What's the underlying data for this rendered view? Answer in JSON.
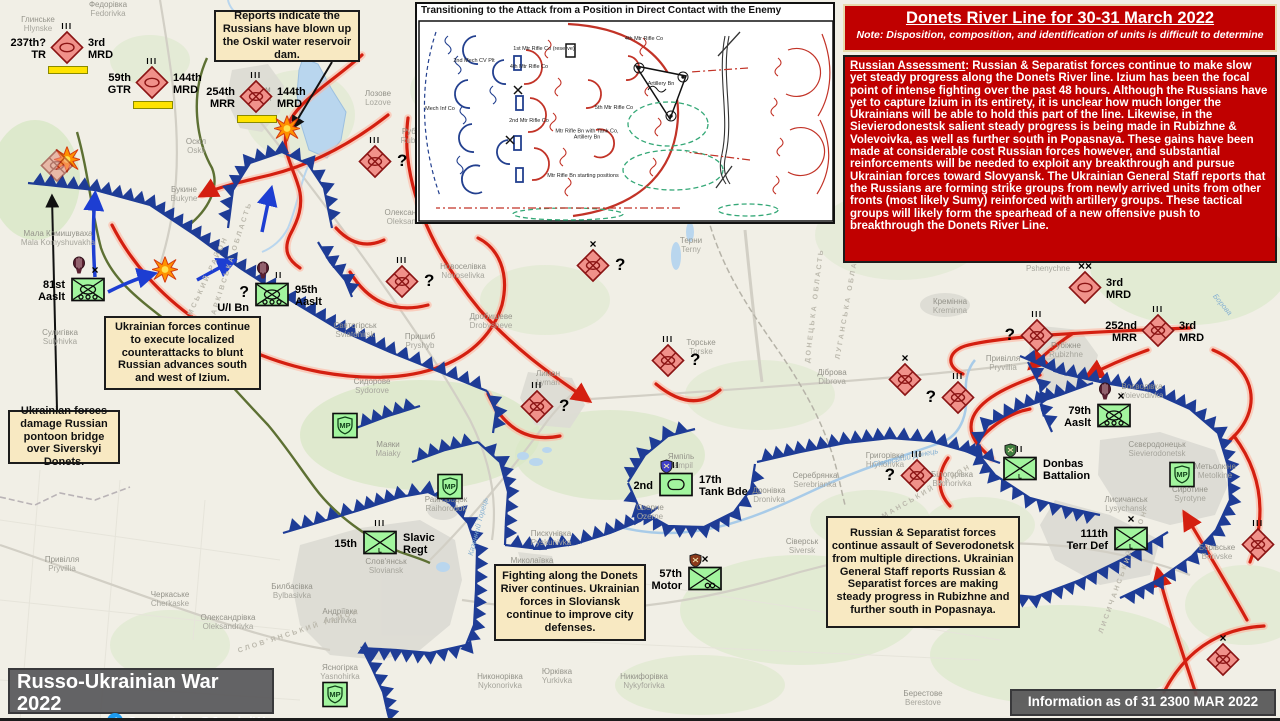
{
  "title_box": {
    "title": "Donets River Line for 30-31 March 2022",
    "note": "Note: Disposition, composition, and identification of units is difficult to determine"
  },
  "assessment": {
    "heading": "Russian Assessment",
    "body": ": Russian & Separatist forces continue to make slow yet steady progress along the Donets River line. Izium has been the focal point of intense fighting over the past 48 hours. Although the Russians have yet to capture Izium in its entirety, it is unclear how much longer the Ukrainians will be able to hold this part of the line. Likewise, in the Sievierodonestsk salient steady progress is being made in Rubizhne & Volevoivka, as well as further south in Popasnaya. These gains have been made at considerable cost Russian forces however, and substantial reinforcements will be needed to exploit any breakthrough and pursue Ukrainian forces toward Slovyansk. The Ukrainian General Staff reports that the Russians are forming strike groups from newly arrived units from other fronts (most likely Sumy) reinforced with artillery groups. These tactical groups will likely form the spearhead of a new offensive push to breakthrough the Donets River Line."
  },
  "inset": {
    "title": "Transitioning to the Attack from a Position in Direct Contact with the Enemy",
    "area_label": "Motorized Rifle Battalion Defensive Area",
    "labels": [
      {
        "text": "1st Mtr Rifle Co (reserve)",
        "x": 127,
        "y": 45
      },
      {
        "text": "4th Mtr Rifle Co",
        "x": 112,
        "y": 63
      },
      {
        "text": "4th Mtr Rifle Co",
        "x": 227,
        "y": 35
      },
      {
        "text": "2nd Mech CV Plt",
        "x": 57,
        "y": 57
      },
      {
        "text": "Mech Inf Co",
        "x": 23,
        "y": 105
      },
      {
        "text": "2nd Mtr Rifle Co",
        "x": 112,
        "y": 117
      },
      {
        "text": "5th Mtr Rifle Co",
        "x": 197,
        "y": 104
      },
      {
        "text": "Mtr Rifle Bn with Tank Co, Artillery Bn",
        "x": 170,
        "y": 131
      },
      {
        "text": "Mtr Rifle Bn starting positions",
        "x": 166,
        "y": 172
      },
      {
        "text": "Artillery Bn",
        "x": 244,
        "y": 80
      }
    ]
  },
  "callouts": [
    {
      "x": 214,
      "y": 10,
      "w": 146,
      "h": 52,
      "text": "Reports indicate the Russians have blown up the Oskil water reservoir dam."
    },
    {
      "x": 104,
      "y": 316,
      "w": 157,
      "h": 74,
      "text": "Ukrainian forces continue to execute localized counterattacks to blunt Russian advances south and west of Izium."
    },
    {
      "x": 8,
      "y": 410,
      "w": 112,
      "h": 54,
      "text": "Ukrainian forces damage Russian pontoon bridge over Siverskyi Donets."
    },
    {
      "x": 494,
      "y": 564,
      "w": 152,
      "h": 77,
      "text": "Fighting along the Donets River continues. Ukrainian forces in Sloviansk continue to improve city defenses."
    },
    {
      "x": 826,
      "y": 516,
      "w": 194,
      "h": 112,
      "text": "Russian & Separatist forces continue assault of Severodonetsk from multiple directions. Ukrainian General Staff reports Russian & Separatist forces are making steady progress in Rubizhne and further south in Popasnaya."
    }
  ],
  "banner": {
    "title": "Russo-Ukrainian War 2022",
    "credit": "Created by @JominiW",
    "icon": "twitter-bird-icon"
  },
  "info_box": {
    "text": "Information as of 31 2300 MAR 2022 (GMT)"
  },
  "colors": {
    "title_red": "#c00000",
    "callout_tan": "#f8e9c2",
    "banner_gray": "#58585a",
    "russian_fill": "#f0918a",
    "russian_border": "#8b1414",
    "ukrainian_fill": "#a2f59e",
    "ukrainian_border": "#0c0c0c",
    "defense_blue": "#1e3c96",
    "attack_red": "#d41f10",
    "attack_glow": "#ffb09a",
    "counter_blue": "#1d3ed2",
    "route_green": "#5d7033",
    "bar_yellow": "#ffe300",
    "water": "#b9d6ee"
  },
  "map": {
    "units": {
      "russian": [
        {
          "x": 67,
          "y": 50,
          "sym": "armor",
          "ech": "III",
          "left": [
            "237th?",
            "TR"
          ],
          "right": [
            "3rd",
            "MRD"
          ],
          "bar": true
        },
        {
          "x": 152,
          "y": 85,
          "sym": "armor",
          "ech": "III",
          "left": [
            "59th",
            "GTR"
          ],
          "right": [
            "144th",
            "MRD"
          ],
          "bar": true
        },
        {
          "x": 256,
          "y": 99,
          "sym": "mech",
          "ech": "III",
          "left": [
            "254th",
            "MRR"
          ],
          "right": [
            "144th",
            "MRD"
          ],
          "bar": true
        },
        {
          "x": 375,
          "y": 164,
          "sym": "mech",
          "ech": "III",
          "q": "right"
        },
        {
          "x": 57,
          "y": 168,
          "sym": "mech",
          "faded": true
        },
        {
          "x": 402,
          "y": 284,
          "sym": "mech",
          "ech": "III",
          "q": "right"
        },
        {
          "x": 593,
          "y": 268,
          "sym": "mech",
          "ech": "x",
          "q": "right"
        },
        {
          "x": 537,
          "y": 409,
          "sym": "mech",
          "ech": "III",
          "q": "right"
        },
        {
          "x": 668,
          "y": 363,
          "sym": "mech",
          "ech": "III",
          "q": "right"
        },
        {
          "x": 1085,
          "y": 290,
          "sym": "armor",
          "ech": "xx",
          "right": [
            "3rd",
            "MRD"
          ]
        },
        {
          "x": 1158,
          "y": 333,
          "sym": "mech",
          "ech": "III",
          "left": [
            "252nd",
            "MRR"
          ],
          "right": [
            "3rd",
            "MRD"
          ]
        },
        {
          "x": 1037,
          "y": 338,
          "sym": "mech",
          "ech": "III",
          "q": "left"
        },
        {
          "x": 958,
          "y": 400,
          "sym": "mech",
          "ech": "III",
          "q": "left"
        },
        {
          "x": 905,
          "y": 382,
          "sym": "mech",
          "ech": "x"
        },
        {
          "x": 917,
          "y": 478,
          "sym": "mech",
          "ech": "III",
          "q": "left"
        },
        {
          "x": 1258,
          "y": 547,
          "sym": "mech",
          "ech": "III"
        },
        {
          "x": 1223,
          "y": 662,
          "sym": "mech",
          "ech": "x"
        }
      ],
      "ukrainian": [
        {
          "x": 88,
          "y": 292,
          "sym": "airassault",
          "ech": "x",
          "balloon": true,
          "left": [
            "81st",
            "Aaslt"
          ]
        },
        {
          "x": 272,
          "y": 297,
          "sym": "airassault",
          "ech": "II",
          "balloon": true,
          "left": [
            "?",
            "U/I Bn"
          ],
          "right": [
            "95th",
            "Aaslt"
          ]
        },
        {
          "x": 1114,
          "y": 418,
          "sym": "airassault",
          "ech": "x",
          "balloon": true,
          "left": [
            "79th",
            "Aaslt"
          ]
        },
        {
          "x": 676,
          "y": 487,
          "sym": "tank",
          "ech": "II",
          "shield": "#4040c8",
          "left": [
            "2nd"
          ],
          "right": [
            "17th",
            "Tank Bde"
          ]
        },
        {
          "x": 380,
          "y": 545,
          "sym": "infL",
          "ech": "III",
          "left": [
            "15th"
          ],
          "right": [
            "Slavic",
            "Regt"
          ]
        },
        {
          "x": 705,
          "y": 581,
          "sym": "motor",
          "ech": "x",
          "shield": "#8b3a1a",
          "left": [
            "57th",
            "Motor"
          ]
        },
        {
          "x": 1131,
          "y": 541,
          "sym": "infL",
          "ech": "x",
          "left": [
            "111th",
            "Terr Def"
          ]
        },
        {
          "x": 1020,
          "y": 471,
          "sym": "infL",
          "ech": "II",
          "shield": "#3f7d3f",
          "right": [
            "Donbas",
            "Battalion"
          ]
        },
        {
          "x": 345,
          "y": 428,
          "sym": "mp"
        },
        {
          "x": 450,
          "y": 489,
          "sym": "mp"
        },
        {
          "x": 335,
          "y": 697,
          "sym": "mp"
        },
        {
          "x": 1182,
          "y": 477,
          "sym": "mp"
        }
      ]
    },
    "explosions": [
      {
        "x": 67,
        "y": 162
      },
      {
        "x": 165,
        "y": 272
      },
      {
        "x": 287,
        "y": 131
      }
    ],
    "places": [
      {
        "uk": "Глинське",
        "en": "Hlynske",
        "x": 38,
        "y": 16
      },
      {
        "uk": "Федорівка",
        "en": "Fedorivka",
        "x": 108,
        "y": 1
      },
      {
        "uk": "Ізюм",
        "en": "Izium",
        "x": 262,
        "y": 86
      },
      {
        "uk": "Лозове",
        "en": "Lozove",
        "x": 378,
        "y": 90
      },
      {
        "uk": "Рубці",
        "en": "Rubtsi",
        "x": 412,
        "y": 128
      },
      {
        "uk": "Оскіл",
        "en": "Oskil",
        "x": 196,
        "y": 138
      },
      {
        "uk": "Букине",
        "en": "Bukyne",
        "x": 184,
        "y": 186
      },
      {
        "uk": "Олександрівка",
        "en": "Oleksandrivka",
        "x": 412,
        "y": 209
      },
      {
        "uk": "Мала Комишуваха",
        "en": "Mala Komyshuvakha",
        "x": 58,
        "y": 230
      },
      {
        "uk": "Сулигівка",
        "en": "Sulyhivka",
        "x": 60,
        "y": 329
      },
      {
        "uk": "Святогірськ",
        "en": "Sviatohirsk",
        "x": 355,
        "y": 322
      },
      {
        "uk": "Пришиб",
        "en": "Pryshyb",
        "x": 420,
        "y": 333
      },
      {
        "uk": "Новоселівка",
        "en": "Novoselivka",
        "x": 463,
        "y": 263
      },
      {
        "uk": "Дробишеве",
        "en": "Drobysheve",
        "x": 491,
        "y": 313
      },
      {
        "uk": "Лиман",
        "en": "Lyman",
        "x": 548,
        "y": 370
      },
      {
        "uk": "Терни",
        "en": "Terny",
        "x": 691,
        "y": 237
      },
      {
        "uk": "Торське",
        "en": "Torske",
        "x": 701,
        "y": 339
      },
      {
        "uk": "Діброва",
        "en": "Dibrova",
        "x": 832,
        "y": 369
      },
      {
        "uk": "Сидорове",
        "en": "Sydorove",
        "x": 372,
        "y": 378
      },
      {
        "uk": "Маяки",
        "en": "Maiaky",
        "x": 388,
        "y": 441
      },
      {
        "uk": "Райгородок",
        "en": "Raihorodok",
        "x": 446,
        "y": 496
      },
      {
        "uk": "Слов'янськ",
        "en": "Sloviansk",
        "x": 386,
        "y": 558
      },
      {
        "uk": "Билбасівка",
        "en": "Bylbasivka",
        "x": 292,
        "y": 583
      },
      {
        "uk": "Андріївка",
        "en": "Andriivka",
        "x": 340,
        "y": 608
      },
      {
        "uk": "Ясногірка",
        "en": "Yasnohirka",
        "x": 340,
        "y": 664
      },
      {
        "uk": "Черкаське",
        "en": "Cherkaske",
        "x": 170,
        "y": 591
      },
      {
        "uk": "Олександрівка",
        "en": "Oleksandrivka",
        "x": 228,
        "y": 614
      },
      {
        "uk": "Привілля",
        "en": "Pryvillia",
        "x": 62,
        "y": 556
      },
      {
        "uk": "Миколаївка",
        "en": "Mykolaivka",
        "x": 532,
        "y": 557
      },
      {
        "uk": "Пискунівка",
        "en": "Pyskunivka",
        "x": 551,
        "y": 530
      },
      {
        "uk": "Дронівка",
        "en": "Dronivka",
        "x": 769,
        "y": 487
      },
      {
        "uk": "Сіверськ",
        "en": "Siversk",
        "x": 802,
        "y": 538
      },
      {
        "uk": "Никонорівка",
        "en": "Nykonorivka",
        "x": 500,
        "y": 673
      },
      {
        "uk": "Юрківка",
        "en": "Yurkivka",
        "x": 557,
        "y": 668
      },
      {
        "uk": "Никифорівка",
        "en": "Nykyforivka",
        "x": 644,
        "y": 673
      },
      {
        "uk": "Ямпіль",
        "en": "Yampil",
        "x": 681,
        "y": 453
      },
      {
        "uk": "Озерне",
        "en": "Ozerne",
        "x": 650,
        "y": 504
      },
      {
        "uk": "Серебрянка",
        "en": "Serebrianka",
        "x": 815,
        "y": 472
      },
      {
        "uk": "Григорівка",
        "en": "Hryhorivka",
        "x": 885,
        "y": 452
      },
      {
        "uk": "Білогорівка",
        "en": "Bilohorivka",
        "x": 952,
        "y": 471
      },
      {
        "uk": "Пшеничне",
        "en": "Pshenychne",
        "x": 1048,
        "y": 256
      },
      {
        "uk": "Кремінна",
        "en": "Kreminna",
        "x": 950,
        "y": 298
      },
      {
        "uk": "Привілля",
        "en": "Pryvillia",
        "x": 1003,
        "y": 355
      },
      {
        "uk": "Рубіжне",
        "en": "Rubizhne",
        "x": 1066,
        "y": 342
      },
      {
        "uk": "Воєводівка",
        "en": "Voievodivka",
        "x": 1142,
        "y": 383
      },
      {
        "uk": "Сєвєродонецьк",
        "en": "Sievierodonetsk",
        "x": 1157,
        "y": 441
      },
      {
        "uk": "Лисичанськ",
        "en": "Lysychansk",
        "x": 1126,
        "y": 496
      },
      {
        "uk": "Метьолкіне",
        "en": "Metolkine",
        "x": 1215,
        "y": 463
      },
      {
        "uk": "Сиротине",
        "en": "Syrotyne",
        "x": 1190,
        "y": 486
      },
      {
        "uk": "Борівське",
        "en": "Borivske",
        "x": 1217,
        "y": 544
      },
      {
        "uk": "Берестове",
        "en": "Berestove",
        "x": 923,
        "y": 690
      }
    ],
    "districts": [
      {
        "text": "ХАРКІВСЬКА ОБЛАСТЬ",
        "x": 168,
        "y": 258,
        "rot": -72
      },
      {
        "text": "ІЗЮМСЬКИЙ РАЙОН",
        "x": 150,
        "y": 282,
        "rot": -65
      },
      {
        "text": "ДОНЕЦЬКА ОБЛАСТЬ",
        "x": 757,
        "y": 302,
        "rot": -83
      },
      {
        "text": "ЛУГАНСЬКА ОБЛАСТЬ",
        "x": 788,
        "y": 296,
        "rot": -80
      },
      {
        "text": "ЛИМАНСЬКИЙ РАЙОН",
        "x": 862,
        "y": 492,
        "rot": -30
      },
      {
        "text": "СЛОВ'ЯНСЬКИЙ РАЙОН",
        "x": 235,
        "y": 628,
        "rot": -18
      },
      {
        "text": "ЛИСИЧАНСЬКИЙ РАЙОН",
        "x": 1058,
        "y": 568,
        "rot": -70
      }
    ],
    "water_labels": [
      {
        "text": "Сіверський Донець",
        "x": 872,
        "y": 453,
        "rot": -12
      },
      {
        "text": "Борова",
        "x": 1210,
        "y": 300,
        "rot": 50
      },
      {
        "text": "Казенний Торець",
        "x": 448,
        "y": 522,
        "rot": -75
      }
    ]
  }
}
